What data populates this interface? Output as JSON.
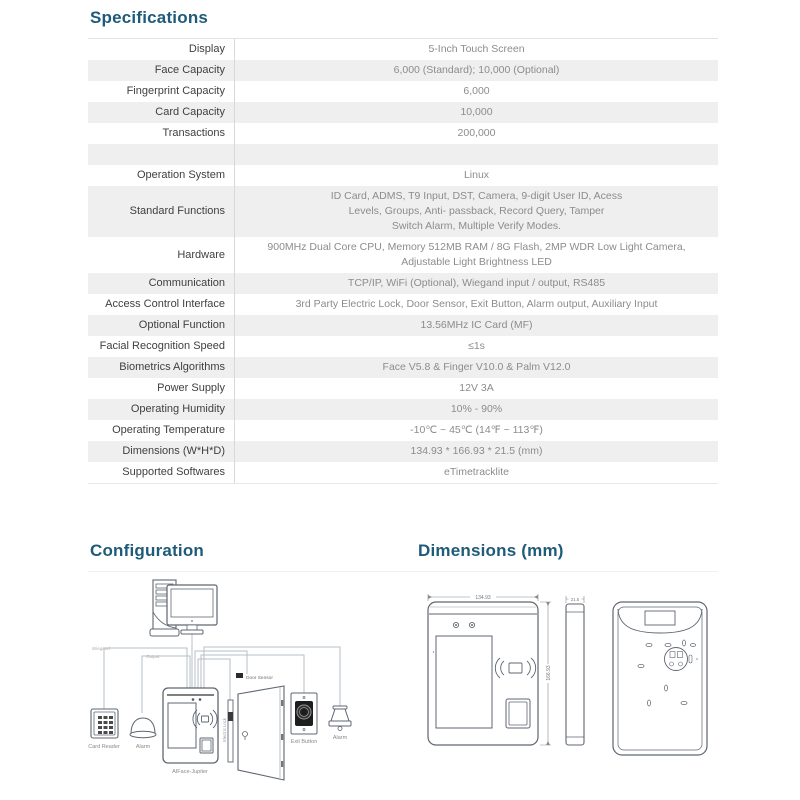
{
  "page": {
    "accent": "#1e5b78",
    "stripe": "#efefef"
  },
  "specifications": {
    "title": "Specifications",
    "rows": [
      {
        "label": "Display",
        "value": "5-Inch Touch Screen"
      },
      {
        "label": "Face Capacity",
        "value": "6,000 (Standard); 10,000 (Optional)"
      },
      {
        "label": "Fingerprint Capacity",
        "value": "6,000"
      },
      {
        "label": "Card Capacity",
        "value": "10,000"
      },
      {
        "label": "Transactions",
        "value": "200,000"
      },
      {
        "label": "",
        "value": ""
      },
      {
        "label": "Operation System",
        "value": "Linux"
      },
      {
        "label": "Standard Functions",
        "value": "ID Card, ADMS, T9 Input, DST, Camera, 9-digit User ID, Acess\nLevels, Groups, Anti- passback, Record Query, Tamper\nSwitch Alarm, Multiple Verify Modes."
      },
      {
        "label": "Hardware",
        "value": "900MHz Dual Core CPU, Memory 512MB RAM / 8G Flash, 2MP WDR Low Light Camera,\nAdjustable Light Brightness LED"
      },
      {
        "label": "Communication",
        "value": "TCP/IP, WiFi (Optional), Wiegand input / output, RS485"
      },
      {
        "label": "Access Control Interface",
        "value": "3rd Party Electric Lock, Door Sensor, Exit Button, Alarm output, Auxiliary Input"
      },
      {
        "label": "Optional Function",
        "value": "13.56MHz IC Card (MF)"
      },
      {
        "label": "Facial Recognition Speed",
        "value": "≤1s"
      },
      {
        "label": "Biometrics Algorithms",
        "value": "Face V5.8 & Finger V10.0 & Palm V12.0"
      },
      {
        "label": "Power Supply",
        "value": "12V 3A"
      },
      {
        "label": "Operating Humidity",
        "value": "10% - 90%"
      },
      {
        "label": "Operating Temperature",
        "value": "-10℃ ~ 45℃ (14℉ ~ 113℉)"
      },
      {
        "label": "Dimensions (W*H*D)",
        "value": "134.93 * 166.93 * 21.5 (mm)"
      },
      {
        "label": "Supported Softwares",
        "value": "eTimetracklite"
      }
    ]
  },
  "configuration": {
    "title": "Configuration",
    "labels": {
      "wiegand": "Wiegand",
      "output": "Output",
      "card_reader": "Card Reader",
      "alarm": "Alarm",
      "device": "AIFace-Jupiter",
      "door_sensor": "Door Sensor",
      "electric_lock": "Electric Lock",
      "exit_button": "Exit Button"
    }
  },
  "dimensions": {
    "title": "Dimensions (mm)",
    "width": "134.93",
    "height": "166.93",
    "depth": "21.5"
  }
}
